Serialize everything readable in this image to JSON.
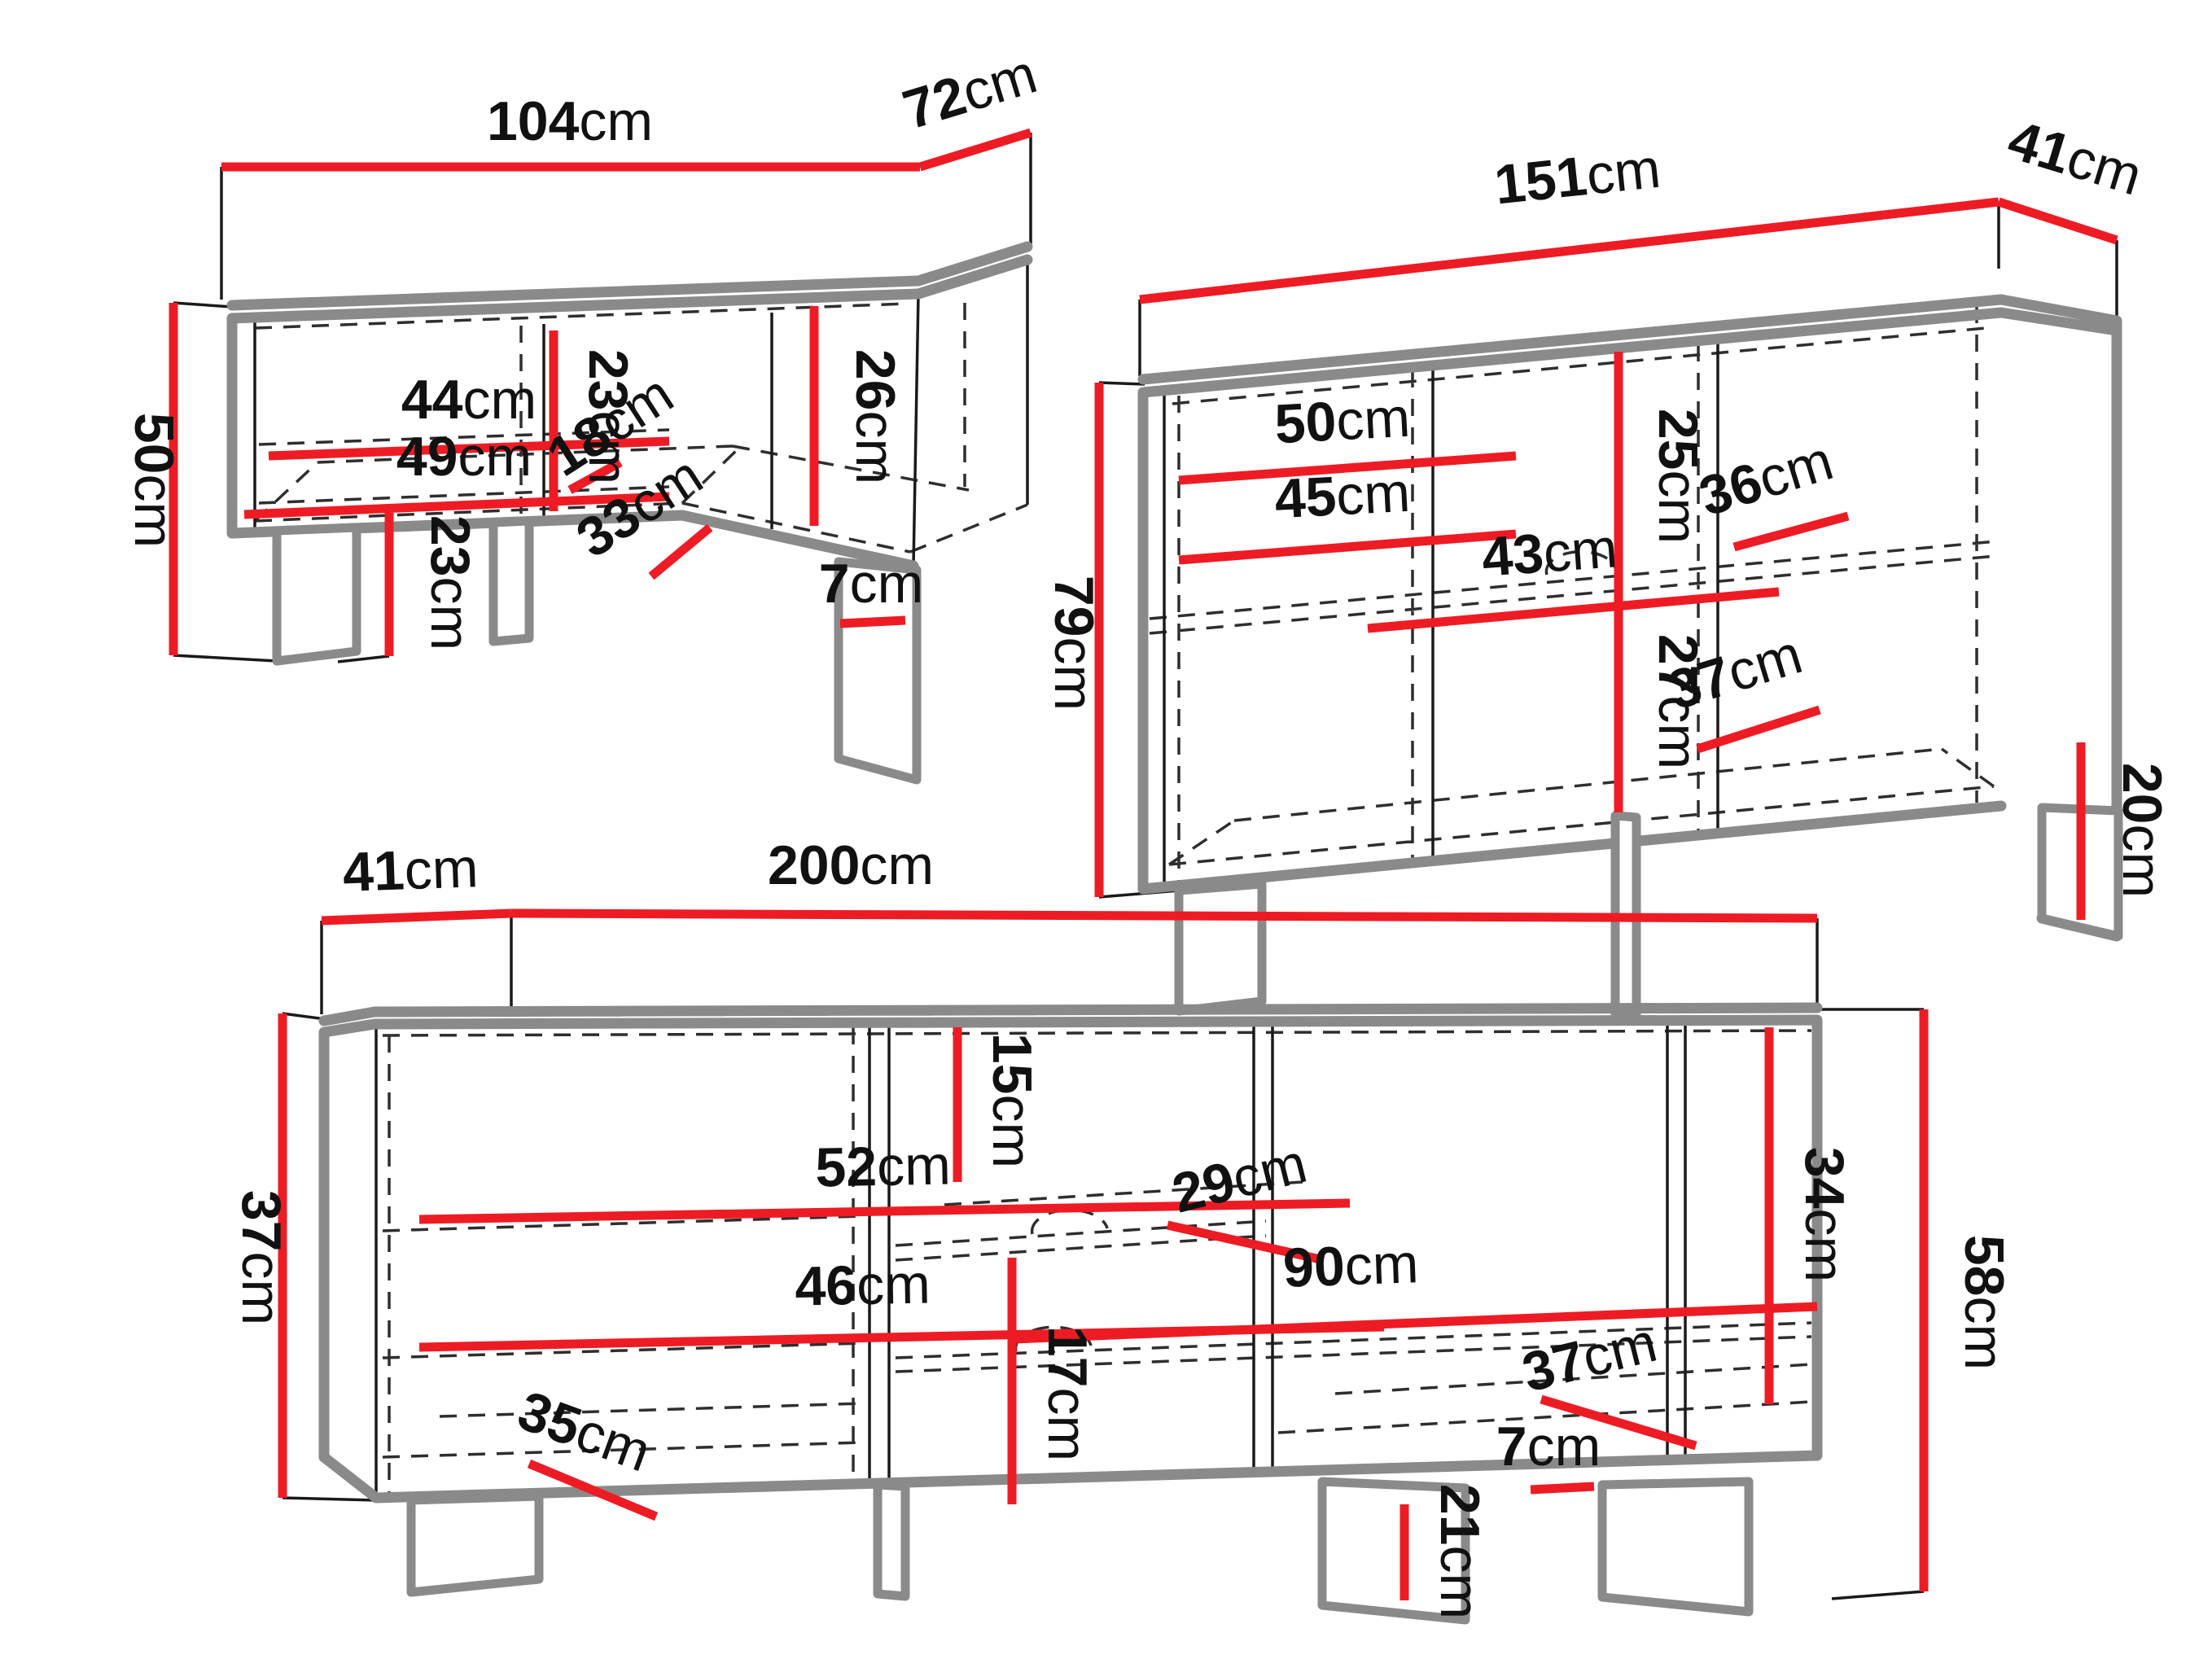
{
  "unit": "cm",
  "colors": {
    "dimension_red": "#ed1c24",
    "edge_gray": "#8a8a8a",
    "line_black": "#1a1a1a",
    "background": "#ffffff",
    "text": "#111111"
  },
  "pieces": [
    {
      "id": "corner-tv-bench",
      "dims": {
        "width": "104",
        "depth": "72",
        "height": "50",
        "shelf_upper": "44",
        "shelf_lower": "49",
        "left_niche_height": "23",
        "niche_depth": "18",
        "niche_width": "33",
        "right_niche_height": "26",
        "leg_height": "23",
        "right_leg_height": "7"
      }
    },
    {
      "id": "sideboard",
      "dims": {
        "width": "151",
        "depth": "41",
        "height": "79",
        "shelf_upper": "50",
        "shelf_lower": "45",
        "upper_niche_height": "25",
        "niche_depth_upper": "36",
        "middle_shelf_width": "43",
        "lower_niche_height": "27",
        "niche_depth_lower": "37",
        "leg_height": "20"
      }
    },
    {
      "id": "tv-stand",
      "dims": {
        "depth": "41",
        "width": "200",
        "left_height": "37",
        "shelf_upper": "52",
        "shelf_lower": "46",
        "upper_niche_height": "15",
        "shelf_depth_upper": "29",
        "middle_shelf_width": "90",
        "lower_niche_height": "17",
        "shelf_depth_lower": "37",
        "right_niche_height": "34",
        "right_height": "58",
        "bottom_shelf_depth": "35",
        "right_leg_height": "7",
        "leg_height": "21"
      }
    }
  ]
}
